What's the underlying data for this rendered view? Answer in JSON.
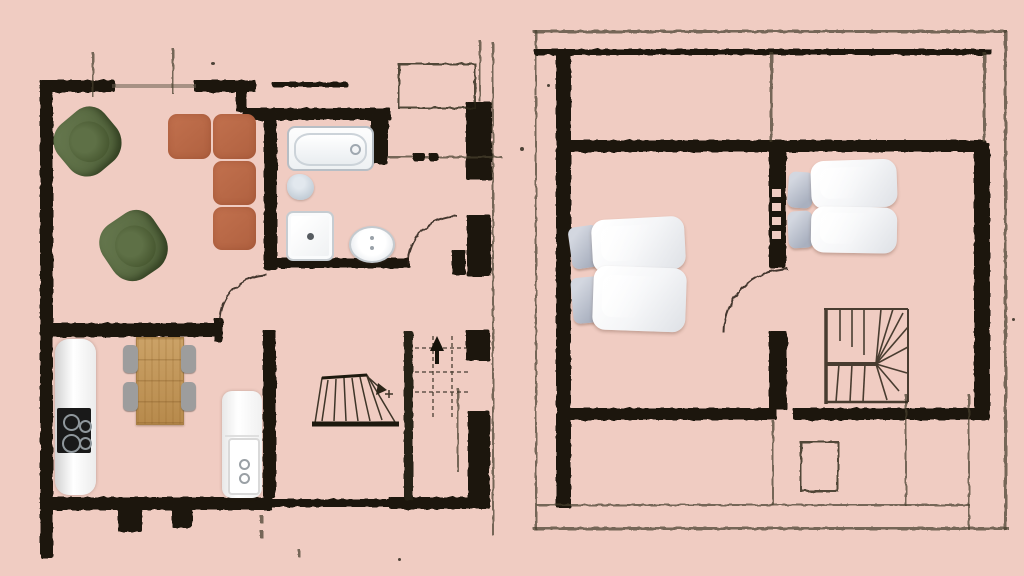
{
  "document": {
    "type": "floor-plan-sketch",
    "plans": [
      {
        "id": "ground-floor",
        "rooms": [
          "living-room",
          "kitchen-dining-room",
          "bathroom",
          "entry-hall",
          "stairwell"
        ]
      },
      {
        "id": "upper-floor",
        "rooms": [
          "bedroom-1",
          "bedroom-2",
          "landing-winder-stairs"
        ]
      }
    ]
  },
  "palette": {
    "background": "#f0ccc2",
    "wall": "#1d180e",
    "wallolive": "#252112",
    "line": "#463f2e",
    "sofa": "#c2714e",
    "armchair": "#4d5e37",
    "wood": "#cba267",
    "chairgray": "#9d9d9d",
    "pillowgray": "#a9b0bf"
  },
  "elements": [
    {
      "p": "g",
      "t": "w",
      "n": "wall-top-a",
      "x": 40,
      "y": 80,
      "w": 75,
      "h": 12
    },
    {
      "p": "g",
      "t": "w",
      "n": "wall-top-b",
      "x": 194,
      "y": 80,
      "w": 62,
      "h": 12
    },
    {
      "p": "g",
      "t": "win",
      "n": "window-top",
      "x": 112,
      "y": 84,
      "w": 84,
      "h": 4
    },
    {
      "p": "g",
      "t": "t",
      "n": "window-tick-a",
      "x": 92,
      "y": 52,
      "w": 2,
      "h": 45
    },
    {
      "p": "g",
      "t": "t",
      "n": "window-tick-b",
      "x": 172,
      "y": 48,
      "w": 2,
      "h": 46
    },
    {
      "p": "g",
      "t": "w",
      "n": "wall-step",
      "x": 236,
      "y": 86,
      "w": 11,
      "h": 26
    },
    {
      "p": "g",
      "t": "w",
      "n": "wall-top-dash",
      "x": 272,
      "y": 82,
      "w": 76,
      "h": 5
    },
    {
      "p": "g",
      "t": "w",
      "n": "bathroom-top-wall",
      "x": 243,
      "y": 108,
      "w": 148,
      "h": 12
    },
    {
      "p": "g",
      "t": "w",
      "n": "bathroom-right-wall",
      "x": 371,
      "y": 114,
      "w": 17,
      "h": 50
    },
    {
      "p": "g",
      "t": "w",
      "n": "corner-column-ne",
      "x": 466,
      "y": 102,
      "w": 26,
      "h": 78
    },
    {
      "p": "g",
      "t": "rl",
      "n": "closet-outline-ne",
      "x": 398,
      "y": 63,
      "w": 74,
      "h": 42
    },
    {
      "p": "g",
      "t": "t",
      "n": "thin-line-e",
      "x": 388,
      "y": 156,
      "w": 114,
      "h": 2
    },
    {
      "p": "g",
      "t": "w",
      "n": "dash-e-a",
      "x": 413,
      "y": 153,
      "w": 12,
      "h": 8
    },
    {
      "p": "g",
      "t": "w",
      "n": "dash-e-b",
      "x": 429,
      "y": 153,
      "w": 9,
      "h": 8
    },
    {
      "p": "g",
      "t": "w",
      "n": "wall-left",
      "x": 40,
      "y": 86,
      "w": 13,
      "h": 472
    },
    {
      "p": "g",
      "t": "w",
      "n": "wall-mid",
      "x": 44,
      "y": 323,
      "w": 174,
      "h": 14
    },
    {
      "p": "g",
      "t": "w",
      "n": "bathroom-left-wall",
      "x": 264,
      "y": 112,
      "w": 13,
      "h": 158
    },
    {
      "p": "g",
      "t": "w",
      "n": "hall-top-wall",
      "x": 264,
      "y": 258,
      "w": 146,
      "h": 10
    },
    {
      "p": "g",
      "t": "w",
      "n": "door-hinge-stub",
      "x": 452,
      "y": 250,
      "w": 14,
      "h": 25
    },
    {
      "p": "g",
      "t": "w",
      "n": "column-e-mid",
      "x": 467,
      "y": 215,
      "w": 24,
      "h": 62
    },
    {
      "p": "g",
      "t": "w",
      "n": "door-jamb",
      "x": 214,
      "y": 318,
      "w": 9,
      "h": 24
    },
    {
      "p": "g",
      "t": "w",
      "n": "kitchen-divider-wall",
      "x": 263,
      "y": 330,
      "w": 13,
      "h": 168
    },
    {
      "p": "g",
      "t": "w",
      "n": "wall-bottom-a",
      "x": 40,
      "y": 497,
      "w": 232,
      "h": 13
    },
    {
      "p": "g",
      "t": "w",
      "n": "wall-bottom-b",
      "x": 270,
      "y": 499,
      "w": 121,
      "h": 8
    },
    {
      "p": "g",
      "t": "w",
      "n": "wall-bottom-c",
      "x": 389,
      "y": 497,
      "w": 101,
      "h": 12
    },
    {
      "p": "g",
      "t": "w",
      "n": "bottom-stub-a",
      "x": 118,
      "y": 505,
      "w": 24,
      "h": 27
    },
    {
      "p": "g",
      "t": "w",
      "n": "bottom-stub-b",
      "x": 172,
      "y": 505,
      "w": 20,
      "h": 23
    },
    {
      "p": "g",
      "t": "w",
      "n": "stairwell-wall",
      "x": 404,
      "y": 331,
      "w": 9,
      "h": 169,
      "s": "o"
    },
    {
      "p": "g",
      "t": "w",
      "n": "block-e-a",
      "x": 466,
      "y": 330,
      "w": 24,
      "h": 31
    },
    {
      "p": "g",
      "t": "w",
      "n": "block-e-b",
      "x": 468,
      "y": 411,
      "w": 22,
      "h": 89
    },
    {
      "p": "g",
      "t": "t",
      "n": "thin-right-edge",
      "x": 492,
      "y": 42,
      "w": 2,
      "h": 494
    },
    {
      "p": "g",
      "t": "t",
      "n": "thin-right-edge-b",
      "x": 479,
      "y": 40,
      "w": 2,
      "h": 62
    },
    {
      "p": "g",
      "t": "t",
      "n": "thin-v-marks",
      "x": 457,
      "y": 388,
      "w": 2,
      "h": 84
    },
    {
      "p": "g",
      "t": "t",
      "n": "ink-mark",
      "x": 260,
      "y": 515,
      "w": 3,
      "h": 8
    },
    {
      "p": "g",
      "t": "t",
      "n": "ink-mark",
      "x": 260,
      "y": 530,
      "w": 3,
      "h": 8
    },
    {
      "p": "g",
      "t": "t",
      "n": "ink-mark",
      "x": 298,
      "y": 549,
      "w": 2,
      "h": 8
    },
    {
      "p": "g",
      "t": "arc",
      "n": "door-arc-living",
      "x": 219,
      "y": 274,
      "w": 46,
      "h": 46
    },
    {
      "p": "g",
      "t": "arc",
      "n": "door-arc-bathroom",
      "x": 407,
      "y": 215,
      "w": 48,
      "h": 48
    },
    {
      "p": "g",
      "t": "s1",
      "n": "staircase-ground",
      "x": 298,
      "y": 328,
      "w": 205,
      "h": 105
    },
    {
      "p": "g",
      "t": "ac",
      "n": "armchair-1",
      "x": 57,
      "y": 111,
      "w": 62,
      "h": 62,
      "r": -40
    },
    {
      "p": "g",
      "t": "ac",
      "n": "armchair-2",
      "x": 103,
      "y": 214,
      "w": 62,
      "h": 64,
      "r": -34
    },
    {
      "p": "g",
      "t": "cu",
      "n": "sofa-cushion-1",
      "x": 168,
      "y": 114,
      "w": 43,
      "h": 45
    },
    {
      "p": "g",
      "t": "cu",
      "n": "sofa-cushion-2",
      "x": 213,
      "y": 114,
      "w": 43,
      "h": 45
    },
    {
      "p": "g",
      "t": "cu",
      "n": "sofa-cushion-3",
      "x": 213,
      "y": 161,
      "w": 43,
      "h": 44
    },
    {
      "p": "g",
      "t": "cu",
      "n": "sofa-cushion-4",
      "x": 213,
      "y": 207,
      "w": 43,
      "h": 43
    },
    {
      "p": "g",
      "t": "tub",
      "n": "bathtub",
      "x": 287,
      "y": 126,
      "w": 83,
      "h": 41
    },
    {
      "p": "g",
      "t": "to",
      "n": "toilet",
      "x": 287,
      "y": 174,
      "w": 27,
      "h": 26
    },
    {
      "p": "g",
      "t": "sh",
      "n": "shower-tray",
      "x": 286,
      "y": 211,
      "w": 44,
      "h": 46
    },
    {
      "p": "g",
      "t": "si",
      "n": "washbasin",
      "x": 349,
      "y": 226,
      "w": 42,
      "h": 33
    },
    {
      "p": "g",
      "t": "co",
      "n": "kitchen-counter",
      "x": 55,
      "y": 339,
      "w": 41,
      "h": 156
    },
    {
      "p": "g",
      "t": "ck",
      "n": "cooktop",
      "x": 57,
      "y": 408,
      "w": 34,
      "h": 45
    },
    {
      "p": "g",
      "t": "ta",
      "n": "dining-table",
      "x": 136,
      "y": 337,
      "w": 46,
      "h": 86
    },
    {
      "p": "g",
      "t": "ch",
      "n": "dining-chair-1",
      "x": 123,
      "y": 345,
      "w": 15,
      "h": 28
    },
    {
      "p": "g",
      "t": "ch",
      "n": "dining-chair-2",
      "x": 123,
      "y": 382,
      "w": 15,
      "h": 29
    },
    {
      "p": "g",
      "t": "ch",
      "n": "dining-chair-3",
      "x": 181,
      "y": 345,
      "w": 15,
      "h": 28
    },
    {
      "p": "g",
      "t": "ch",
      "n": "dining-chair-4",
      "x": 181,
      "y": 382,
      "w": 15,
      "h": 29
    },
    {
      "p": "g",
      "t": "ap",
      "n": "appliance",
      "x": 222,
      "y": 391,
      "w": 40,
      "h": 107
    },
    {
      "p": "u",
      "t": "t",
      "n": "outer-top",
      "x": 533,
      "y": 30,
      "w": 474,
      "h": 3
    },
    {
      "p": "u",
      "t": "t",
      "n": "outer-right",
      "x": 1004,
      "y": 30,
      "w": 3,
      "h": 500
    },
    {
      "p": "u",
      "t": "t",
      "n": "outer-bottom",
      "x": 533,
      "y": 527,
      "w": 476,
      "h": 3
    },
    {
      "p": "u",
      "t": "t",
      "n": "outer-left-a",
      "x": 535,
      "y": 30,
      "w": 2,
      "h": 66
    },
    {
      "p": "u",
      "t": "t",
      "n": "outer-left-b",
      "x": 535,
      "y": 96,
      "w": 2,
      "h": 434
    },
    {
      "p": "u",
      "t": "w",
      "n": "top-wall",
      "x": 534,
      "y": 49,
      "w": 458,
      "h": 6
    },
    {
      "p": "u",
      "t": "w",
      "n": "left-wall",
      "x": 556,
      "y": 49,
      "w": 15,
      "h": 459
    },
    {
      "p": "u",
      "t": "w",
      "n": "floor-divider-wall",
      "x": 566,
      "y": 140,
      "w": 420,
      "h": 12
    },
    {
      "p": "u",
      "t": "t",
      "n": "room-divider-thin",
      "x": 770,
      "y": 52,
      "w": 3,
      "h": 90
    },
    {
      "p": "u",
      "t": "t",
      "n": "room-right-thin",
      "x": 983,
      "y": 52,
      "w": 3,
      "h": 90
    },
    {
      "p": "u",
      "t": "w",
      "n": "mid-wall-upper",
      "x": 769,
      "y": 146,
      "w": 17,
      "h": 122
    },
    {
      "p": "u",
      "t": "notch",
      "n": "wall-notch",
      "x": 772,
      "y": 189,
      "w": 9,
      "h": 8
    },
    {
      "p": "u",
      "t": "notch",
      "n": "wall-notch",
      "x": 772,
      "y": 203,
      "w": 9,
      "h": 8
    },
    {
      "p": "u",
      "t": "notch",
      "n": "wall-notch",
      "x": 772,
      "y": 217,
      "w": 9,
      "h": 8
    },
    {
      "p": "u",
      "t": "notch",
      "n": "wall-notch",
      "x": 772,
      "y": 231,
      "w": 9,
      "h": 8
    },
    {
      "p": "u",
      "t": "w",
      "n": "mid-wall-lower",
      "x": 769,
      "y": 331,
      "w": 18,
      "h": 79
    },
    {
      "p": "u",
      "t": "w",
      "n": "right-wall",
      "x": 974,
      "y": 143,
      "w": 16,
      "h": 276
    },
    {
      "p": "u",
      "t": "w",
      "n": "bottom-wall-a",
      "x": 566,
      "y": 408,
      "w": 211,
      "h": 12
    },
    {
      "p": "u",
      "t": "w",
      "n": "bottom-wall-b",
      "x": 793,
      "y": 408,
      "w": 196,
      "h": 12
    },
    {
      "p": "u",
      "t": "arc",
      "n": "door-arc-bedroom",
      "x": 723,
      "y": 268,
      "w": 63,
      "h": 63
    },
    {
      "p": "u",
      "t": "t",
      "n": "thin-v-a",
      "x": 772,
      "y": 420,
      "w": 2,
      "h": 86
    },
    {
      "p": "u",
      "t": "t",
      "n": "thin-v-b",
      "x": 905,
      "y": 394,
      "w": 2,
      "h": 112
    },
    {
      "p": "u",
      "t": "t",
      "n": "thin-v-c",
      "x": 968,
      "y": 394,
      "w": 2,
      "h": 136
    },
    {
      "p": "u",
      "t": "t",
      "n": "thin-h-bottom",
      "x": 537,
      "y": 504,
      "w": 433,
      "h": 2
    },
    {
      "p": "u",
      "t": "rl",
      "n": "hatch-outline",
      "x": 800,
      "y": 441,
      "w": 35,
      "h": 47
    },
    {
      "p": "u",
      "t": "s2",
      "n": "staircase-upper",
      "x": 819,
      "y": 299,
      "w": 92,
      "h": 108
    },
    {
      "p": "u",
      "t": "ps",
      "n": "pillow-small-1",
      "x": 570,
      "y": 226,
      "w": 30,
      "h": 42,
      "r": -8
    },
    {
      "p": "u",
      "t": "ps",
      "n": "pillow-small-2",
      "x": 572,
      "y": 277,
      "w": 31,
      "h": 46,
      "r": -5
    },
    {
      "p": "u",
      "t": "pl",
      "n": "duvet-pillow-1",
      "x": 592,
      "y": 218,
      "w": 93,
      "h": 53,
      "r": -3
    },
    {
      "p": "u",
      "t": "pl",
      "n": "duvet-pillow-2",
      "x": 593,
      "y": 267,
      "w": 93,
      "h": 64,
      "r": 2
    },
    {
      "p": "u",
      "t": "ps",
      "n": "pillow-small-3",
      "x": 788,
      "y": 172,
      "w": 25,
      "h": 36,
      "r": 4
    },
    {
      "p": "u",
      "t": "ps",
      "n": "pillow-small-4",
      "x": 788,
      "y": 211,
      "w": 25,
      "h": 37,
      "r": -3
    },
    {
      "p": "u",
      "t": "pl",
      "n": "duvet-pillow-3",
      "x": 811,
      "y": 160,
      "w": 86,
      "h": 48,
      "r": -2
    },
    {
      "p": "u",
      "t": "pl",
      "n": "duvet-pillow-4",
      "x": 811,
      "y": 207,
      "w": 86,
      "h": 46,
      "r": 1
    },
    {
      "p": "g",
      "t": "sp",
      "n": "ink-speck",
      "x": 520,
      "y": 147,
      "w": 4,
      "h": 4
    },
    {
      "p": "g",
      "t": "sp",
      "n": "ink-speck",
      "x": 547,
      "y": 84,
      "w": 3,
      "h": 3
    },
    {
      "p": "g",
      "t": "sp",
      "n": "ink-speck",
      "x": 398,
      "y": 558,
      "w": 3,
      "h": 3
    },
    {
      "p": "g",
      "t": "sp",
      "n": "ink-speck",
      "x": 211,
      "y": 62,
      "w": 4,
      "h": 3
    },
    {
      "p": "u",
      "t": "sp",
      "n": "ink-speck",
      "x": 1012,
      "y": 318,
      "w": 3,
      "h": 3
    }
  ]
}
